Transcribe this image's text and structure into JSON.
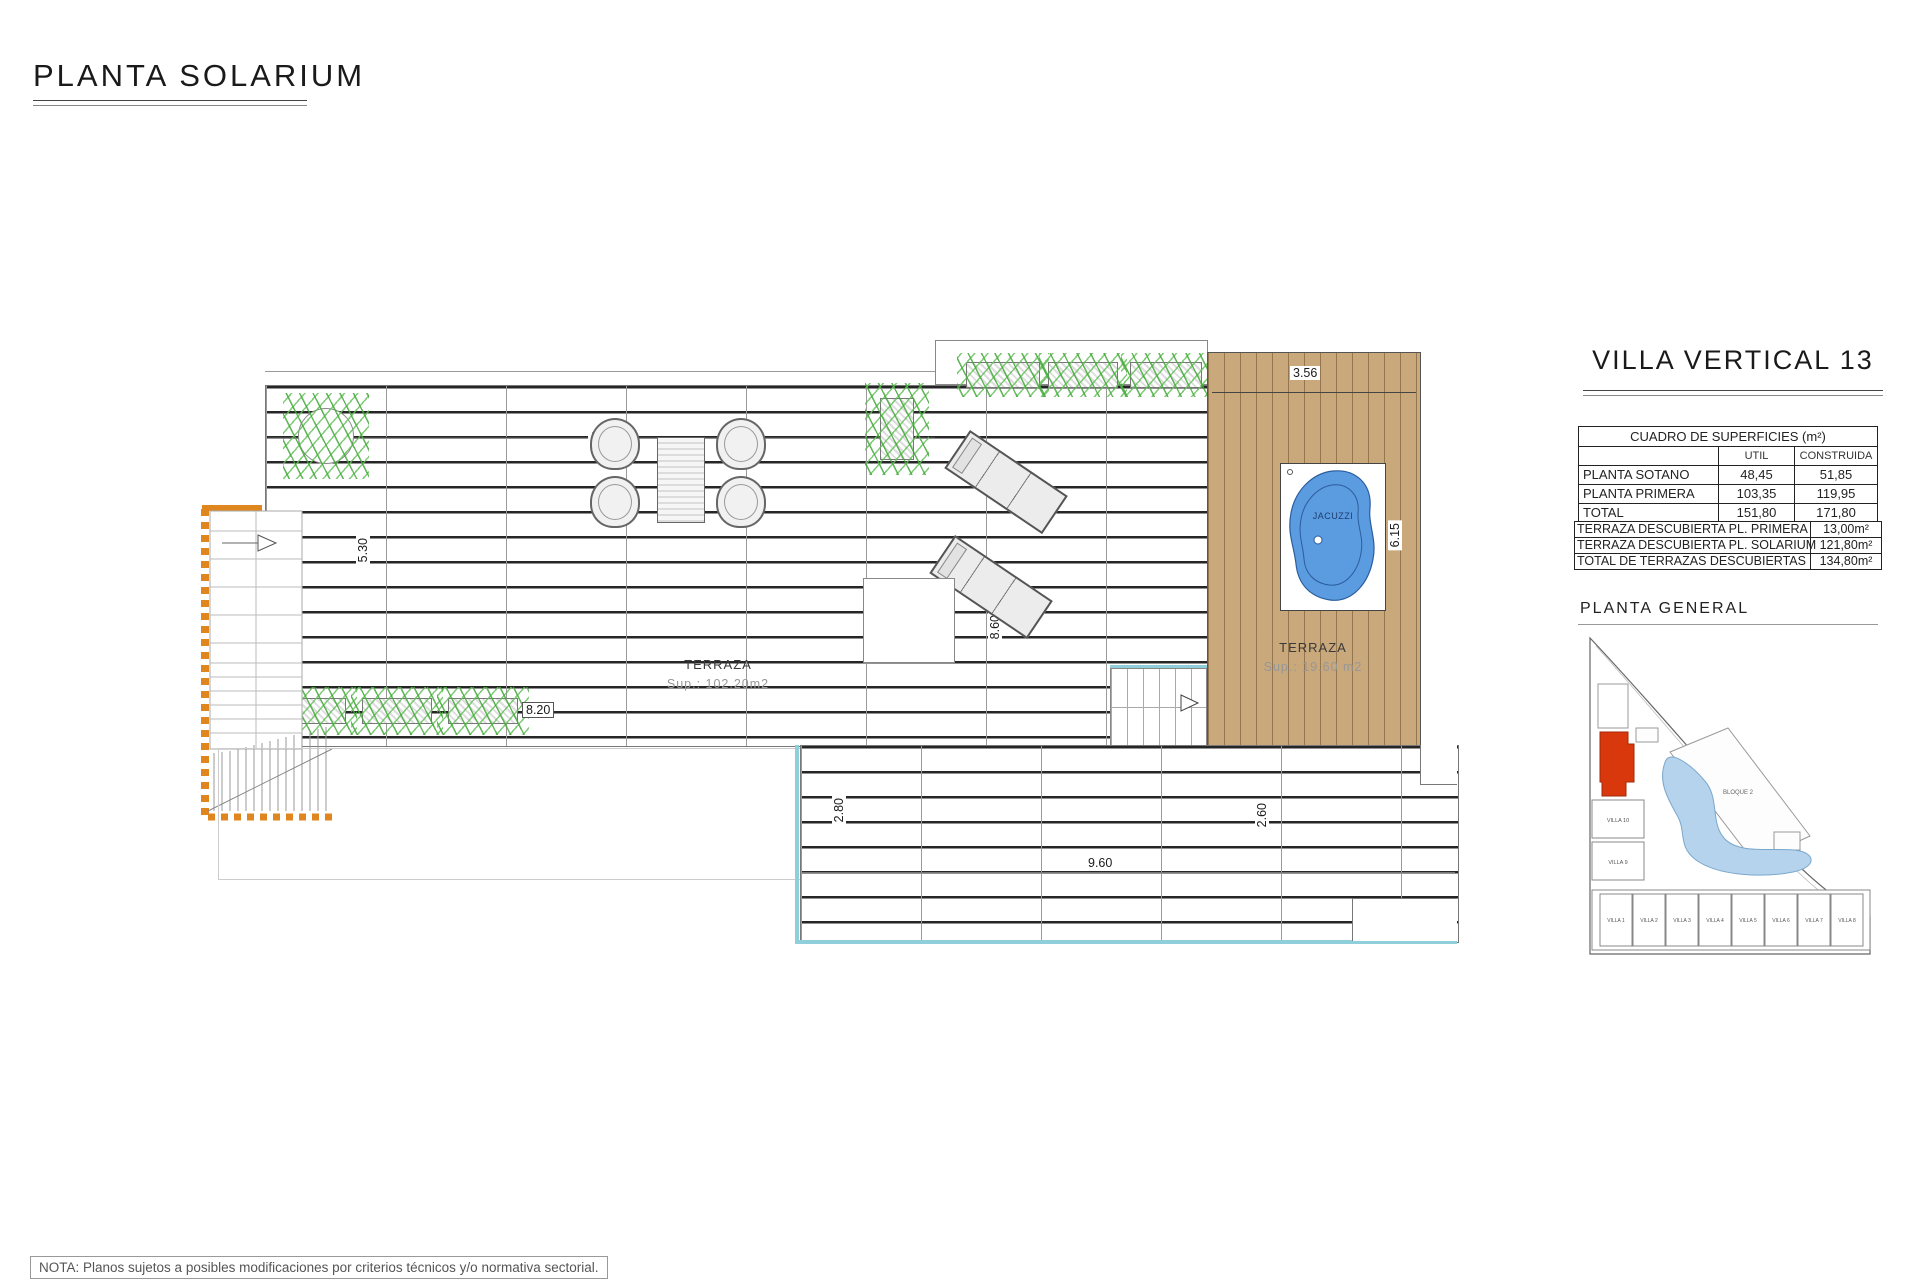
{
  "title": "PLANTA SOLARIUM",
  "note": "NOTA: Planos sujetos a posibles modificaciones por criterios técnicos y/o normativa sectorial.",
  "plan": {
    "terraza_main": {
      "name": "TERRAZA",
      "area": "Sup.: 102.20m2"
    },
    "terraza_deck": {
      "name": "TERRAZA",
      "area": "Sup.: 19.60  m2"
    },
    "jacuzzi": "JACUZZI",
    "dims": {
      "top_width": "14.32",
      "deck_width": "3.56",
      "left_height": "5.30",
      "mid_height": "8.60",
      "deck_height": "6.15",
      "planter_width": "8.20",
      "lower_left_height": "2.80",
      "lower_width": "9.60",
      "lower_right_height": "2.60"
    }
  },
  "panel": {
    "villa_title": "VILLA VERTICAL 13",
    "surfaces": {
      "title": "CUADRO DE SUPERFICIES (m²)",
      "col_util": "UTIL",
      "col_construida": "CONSTRUIDA",
      "rows": [
        {
          "name": "PLANTA SOTANO",
          "util": "48,45",
          "construida": "51,85"
        },
        {
          "name": "PLANTA PRIMERA",
          "util": "103,35",
          "construida": "119,95"
        },
        {
          "name": "TOTAL",
          "util": "151,80",
          "construida": "171,80"
        }
      ]
    },
    "terraces": {
      "rows": [
        {
          "name": "TERRAZA DESCUBIERTA PL. PRIMERA",
          "value": "13,00m²"
        },
        {
          "name": "TERRAZA DESCUBIERTA PL. SOLARIUM",
          "value": "121,80m²"
        },
        {
          "name": "TOTAL DE TERRAZAS DESCUBIERTAS",
          "value": "134,80m²"
        }
      ]
    },
    "site": {
      "title": "PLANTA GENERAL",
      "bloque": "BLOQUE 2",
      "left_villas": [
        "VILLA 10",
        "VILLA 9"
      ],
      "bottom_villas": [
        "VILLA 1",
        "VILLA 2",
        "VILLA 3",
        "VILLA 4",
        "VILLA 5",
        "VILLA 6",
        "VILLA 7",
        "VILLA 8"
      ]
    }
  },
  "colors": {
    "deck_wood": "#c9a87b",
    "jacuzzi_fill": "#5b9be0",
    "plant_green": "#4fae4a",
    "stair_orange": "#e0861f",
    "pool_edge_cyan": "#8ecfdb",
    "site_highlight_red": "#d9380c",
    "site_lagoon_blue": "#b5d3ec"
  }
}
